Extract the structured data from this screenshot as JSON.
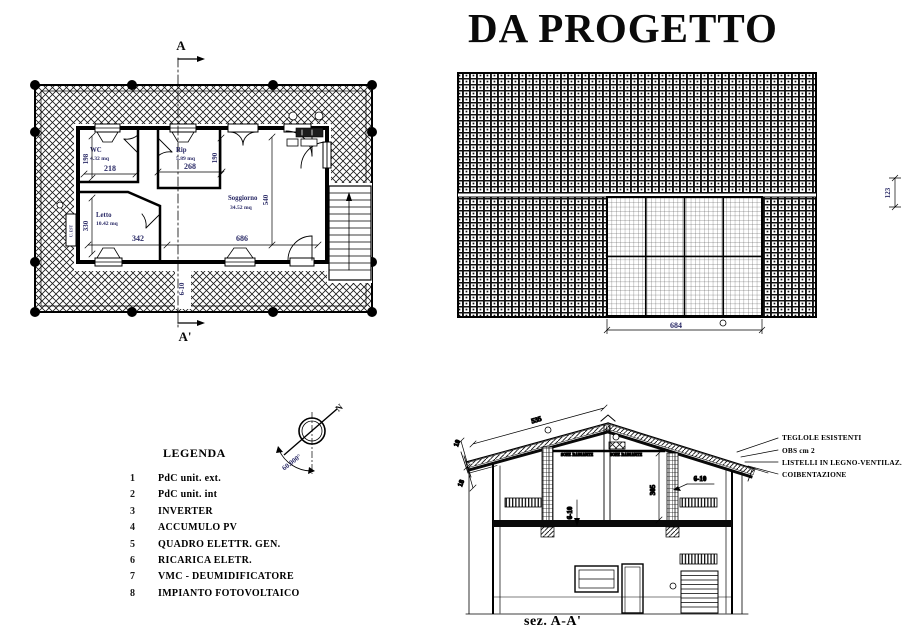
{
  "title": "DA PROGETTO",
  "floor_plan": {
    "marker_top": "A",
    "marker_bottom": "A'",
    "rooms": {
      "wc": {
        "name": "WC",
        "area": "4.32 mq"
      },
      "rip": {
        "name": "Rip",
        "area": "5.89 mq"
      },
      "letto": {
        "name": "Letto",
        "area": "10.42 mq"
      },
      "soggiorno": {
        "name": "Soggiorno",
        "area": "34.52 mq"
      }
    },
    "dims": {
      "wc_h": "198",
      "wc_w": "218",
      "rip_w": "268",
      "rip_h": "190",
      "letto_h": "330",
      "letto_w": "342",
      "sogg_w": "686",
      "sogg_h": "540",
      "slab": "6-10"
    },
    "unit_ext_label": "U. EST"
  },
  "roof_plan": {
    "dims": {
      "pv_width": "684",
      "edge": "123"
    }
  },
  "compass": {
    "north_label": "N",
    "angle_label": "60.000°"
  },
  "legend": {
    "heading": "LEGENDA",
    "items": [
      {
        "num": "1",
        "label": "PdC unit. ext."
      },
      {
        "num": "2",
        "label": "PdC unit. int"
      },
      {
        "num": "3",
        "label": "INVERTER"
      },
      {
        "num": "4",
        "label": "ACCUMULO PV"
      },
      {
        "num": "5",
        "label": "QUADRO ELETTR. GEN."
      },
      {
        "num": "6",
        "label": "RICARICA ELETR."
      },
      {
        "num": "7",
        "label": "VMC - DEUMIDIFICATORE"
      },
      {
        "num": "8",
        "label": "IMPIANTO FOTOVOLTAICO"
      }
    ]
  },
  "section": {
    "caption": "sez. A-A'",
    "dims": {
      "roof_slope": "535",
      "roof_t1": "10",
      "roof_t2": "18",
      "room_h": "305",
      "slab_left": "6-10",
      "slab_right": "6-10"
    },
    "soffit_label": "SOFF. RADIANTE",
    "callouts": [
      "TEGLOLE ESISTENTI",
      "OBS cm 2",
      "LISTELLI IN LEGNO-VENTILAZ.",
      "COIBENTAZIONE"
    ]
  },
  "colors": {
    "line": "#000000",
    "dim_text": "#2a2a66"
  }
}
